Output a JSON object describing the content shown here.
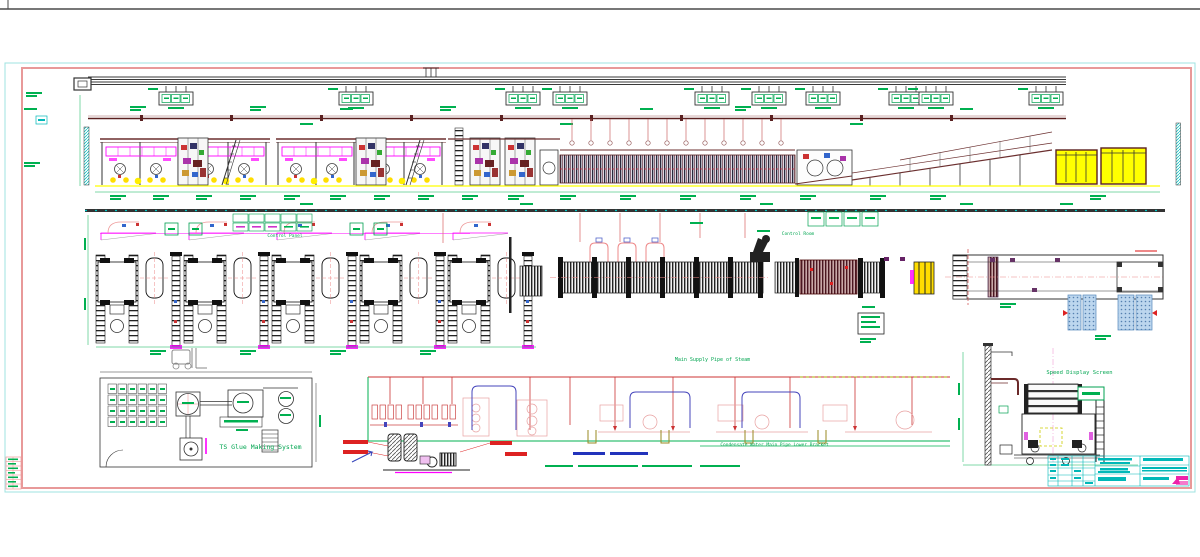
{
  "labels": {
    "glue_system": "TS Glue Making System",
    "speed_screen": "Speed Display Screen",
    "steam_main": "Main Supply Pipe of Steam",
    "condensate_bracket": "Condensate Water Main Pipe Lower Bracket",
    "control_panel": "Control Panel",
    "control_room": "Control Room"
  },
  "colors": {
    "frame_cyan": "#9fe3e0",
    "border_pink": "#e89999",
    "annotation_green": "#00b050",
    "magenta": "#ff00ff",
    "maroon": "#6b2f2f",
    "piping_red": "#cc3333",
    "piping_blue": "#4444bb",
    "highlight_yellow": "#ffff00",
    "titleblock_cyan": "#00b8b8",
    "pallet_blue": "#b8d4ec"
  }
}
